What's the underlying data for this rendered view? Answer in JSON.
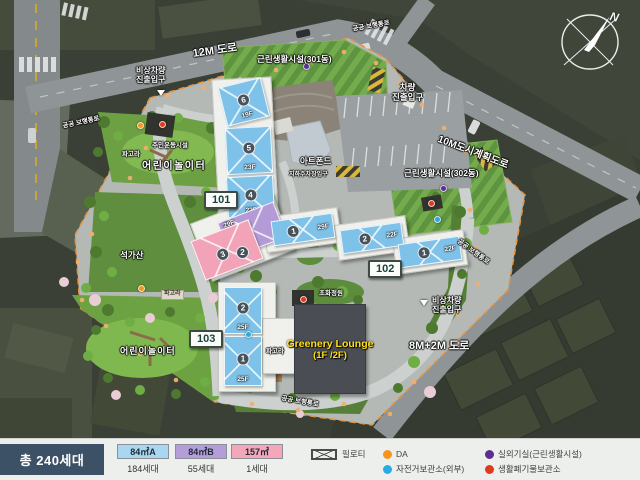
{
  "map": {
    "roads": {
      "r12m": "12M 도로",
      "r10m": "10M도시계획도로",
      "r8m": "8M+2M 도로"
    },
    "labels": {
      "public_path": "공공 보행통로",
      "emergency_entrance": "비상차량\n진출입구",
      "vehicle_entrance": "차량\n진출입구",
      "facility_301": "근린생활시설(301동)",
      "facility_302": "근린생활시설(302동)",
      "art_pond": "아트폰드",
      "underground_parking": "지하주차장입구",
      "residents_exercise": "주민운동시설",
      "pergola": "파고라",
      "rock_garden": "석가산",
      "playground": "어린이놀이터",
      "flower_garden": "초화정원",
      "greenery_lounge_1": "Greenery Lounge",
      "greenery_lounge_2": "(1F /2F)"
    },
    "badges": {
      "b101": "101",
      "b102": "102",
      "b103": "103"
    },
    "buildings": {
      "b101": {
        "units": [
          {
            "no": "6",
            "floors": "19F"
          },
          {
            "no": "5",
            "floors": "23F"
          },
          {
            "no": "4",
            "floors": "22F"
          },
          {
            "no": "3"
          },
          {
            "no": "2",
            "floors": "29F"
          },
          {
            "no": "1",
            "floors": "29F"
          }
        ]
      },
      "b102": {
        "units": [
          {
            "no": "2",
            "floors": "22F"
          },
          {
            "no": "1",
            "floors": "22F"
          }
        ]
      },
      "b103": {
        "units": [
          {
            "no": "2",
            "floors": "25F"
          },
          {
            "no": "1",
            "floors": "25F"
          }
        ]
      }
    },
    "compass_n": "N"
  },
  "legend": {
    "total": "총 240세대",
    "types": [
      {
        "label": "84㎡A",
        "count": "184세대",
        "color": "#a9d7f2"
      },
      {
        "label": "84㎡B",
        "count": "55세대",
        "color": "#b59dda"
      },
      {
        "label": "157㎡",
        "count": "1세대",
        "color": "#f4a6ba"
      }
    ],
    "piloti": "필로티",
    "markers": [
      {
        "label": "DA",
        "color": "#f7941d"
      },
      {
        "label": "자전거보관소(외부)",
        "color": "#29abe2"
      },
      {
        "label": "실외기실(근린생활시설)",
        "color": "#5b2f91"
      },
      {
        "label": "생활폐기물보관소",
        "color": "#e0391f"
      }
    ]
  }
}
